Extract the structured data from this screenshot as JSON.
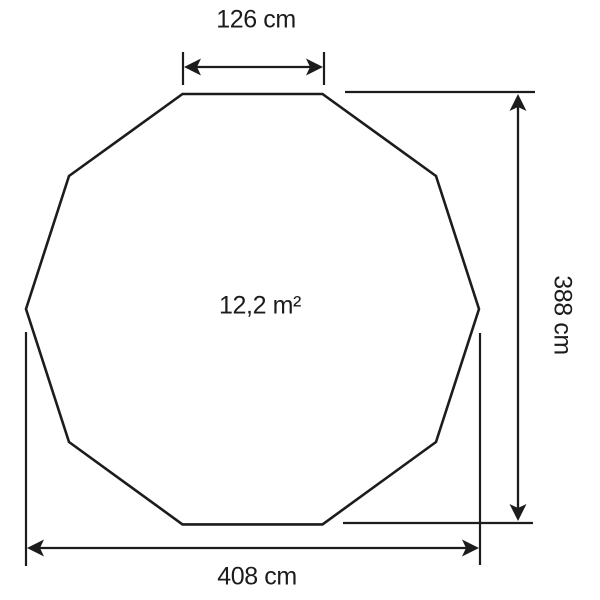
{
  "diagram": {
    "shape": {
      "type": "regular-decagon",
      "sides": 10
    },
    "dimensions": {
      "top_width": {
        "label": "126 cm",
        "value": 126,
        "unit": "cm"
      },
      "height": {
        "label": "388 cm",
        "value": 388,
        "unit": "cm"
      },
      "bottom_width": {
        "label": "408 cm",
        "value": 408,
        "unit": "cm"
      },
      "area": {
        "label": "12,2 m²",
        "value": 12.2,
        "unit": "m²"
      }
    },
    "colors": {
      "line": "#1c1c1c",
      "background": "#ffffff"
    }
  }
}
